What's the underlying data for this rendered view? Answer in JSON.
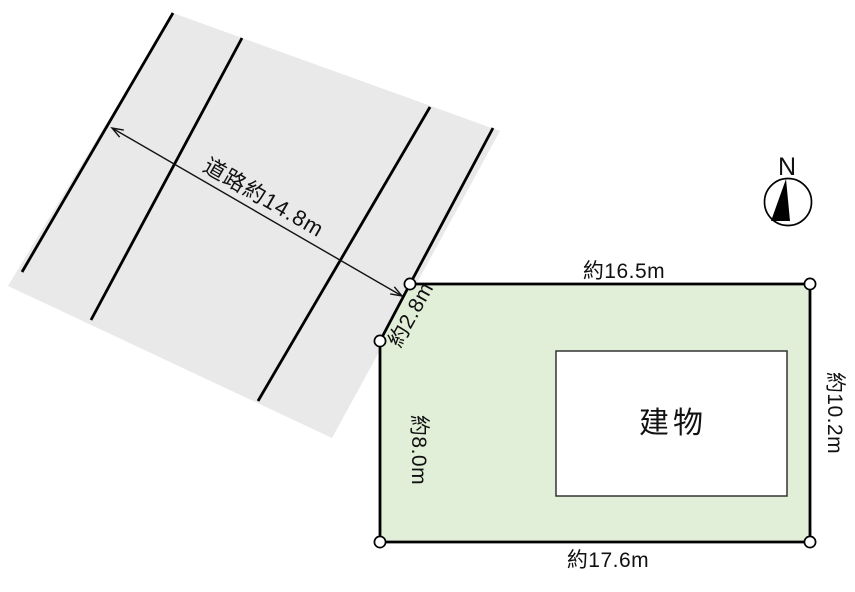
{
  "road": {
    "label": "道路約14.8m",
    "fill": "#e9e9e9",
    "line_color": "#000000"
  },
  "plot": {
    "fill": "#e1efd9",
    "outline_color": "#000000",
    "dimensions": {
      "top": "約16.5m",
      "bottom": "約17.6m",
      "right": "約10.2m",
      "left": "約8.0m",
      "bevel": "約2.8m"
    },
    "building": {
      "label": "建物",
      "fill": "#ffffff",
      "outline_color": "#333333"
    }
  },
  "compass": {
    "north_label": "N",
    "needle_color": "#000000"
  }
}
